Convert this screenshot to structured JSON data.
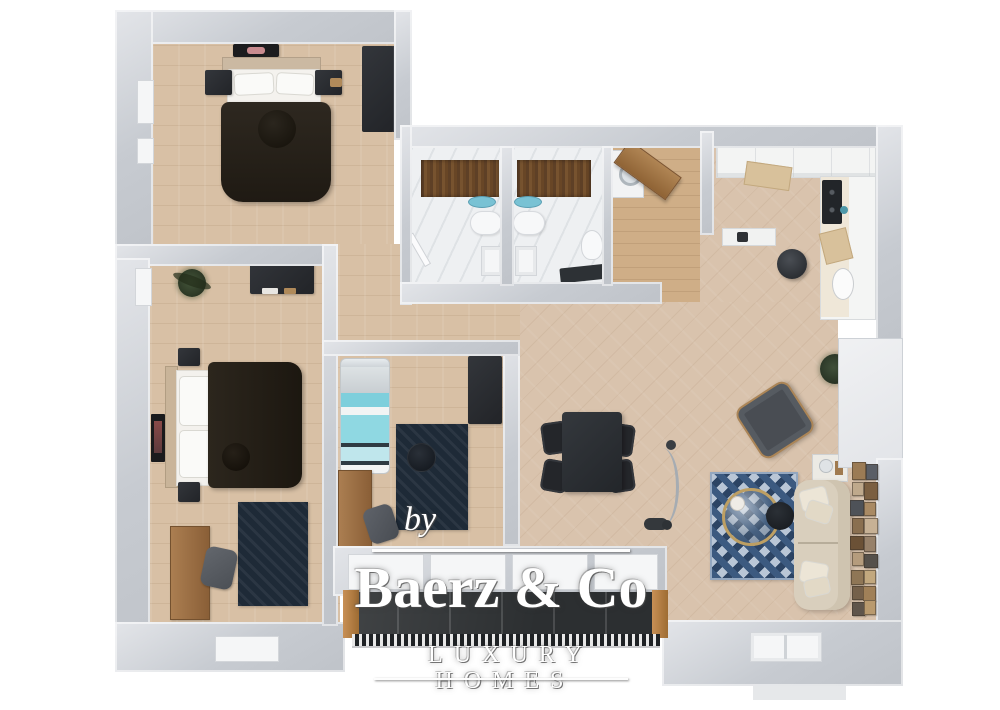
{
  "watermark": {
    "prefix": "by",
    "brand": "Baerz & Co",
    "tagline": "LUXURY HOMES"
  },
  "palette": {
    "wall": "#c7cbd1",
    "wall_light": "#e3e5e9",
    "wall_face": "#f3f4f6",
    "floor_wood": "#d8c0a5",
    "floor_living": "#d9c3ad",
    "floor_entry": "#cfae87",
    "floor_marble": "#eef0f2",
    "dark": "#2a2c30",
    "duvet": "#26211a",
    "wood": "#a1754a",
    "navy": "#1e2a37",
    "teal": "#82d2de",
    "sofa": "#d9cfbd",
    "rug_blue": "#3c5a80",
    "glass": "#2c2f31",
    "rail_wood": "#b98346",
    "white": "#ffffff"
  },
  "scene": {
    "type": "3d-floor-plan-top-view",
    "rooms": [
      {
        "name": "bedroom-1",
        "position": "top-left",
        "furniture": [
          "double-bed",
          "two-nightstands",
          "wardrobe",
          "wall-art"
        ]
      },
      {
        "name": "bedroom-2",
        "position": "middle-left",
        "furniture": [
          "double-bed",
          "two-nightstands",
          "dresser",
          "desk",
          "chair",
          "navy-rug",
          "plant",
          "wall-art"
        ]
      },
      {
        "name": "kids-room",
        "position": "center",
        "furniture": [
          "single-bed-striped",
          "wardrobe",
          "desk",
          "chair",
          "navy-rug",
          "round-pouf"
        ]
      },
      {
        "name": "bathroom-left",
        "position": "center-top",
        "furniture": [
          "wood-shower-wall",
          "teal-basin",
          "vanity",
          "shower-tray",
          "door-leaf"
        ]
      },
      {
        "name": "bathroom-right",
        "position": "center-top",
        "furniture": [
          "wood-shower-wall",
          "teal-basin",
          "vanity",
          "shower-tray",
          "toilet",
          "dark-bench"
        ]
      },
      {
        "name": "entry-hall",
        "position": "top-center-right",
        "furniture": [
          "diagonal-wardrobe",
          "washing-machine",
          "console-shelf"
        ]
      },
      {
        "name": "kitchen",
        "position": "top-right",
        "furniture": [
          "upper-cabinet-run",
          "counter-column",
          "cooktop",
          "sink",
          "cutting-boards",
          "round-stool"
        ]
      },
      {
        "name": "living-dining",
        "position": "right",
        "furniture": [
          "dining-table",
          "four-chairs",
          "arc-floor-lamp",
          "armchair",
          "blue-diamond-rug",
          "round-glass-coffee-table",
          "dark-side-table",
          "cream-sofa",
          "sofa-side-table",
          "gallery-wall",
          "plant",
          "bottom-window"
        ]
      },
      {
        "name": "balcony",
        "position": "bottom-center",
        "furniture": [
          "sliding-glass-doors",
          "wood-posts",
          "railing"
        ]
      }
    ]
  }
}
